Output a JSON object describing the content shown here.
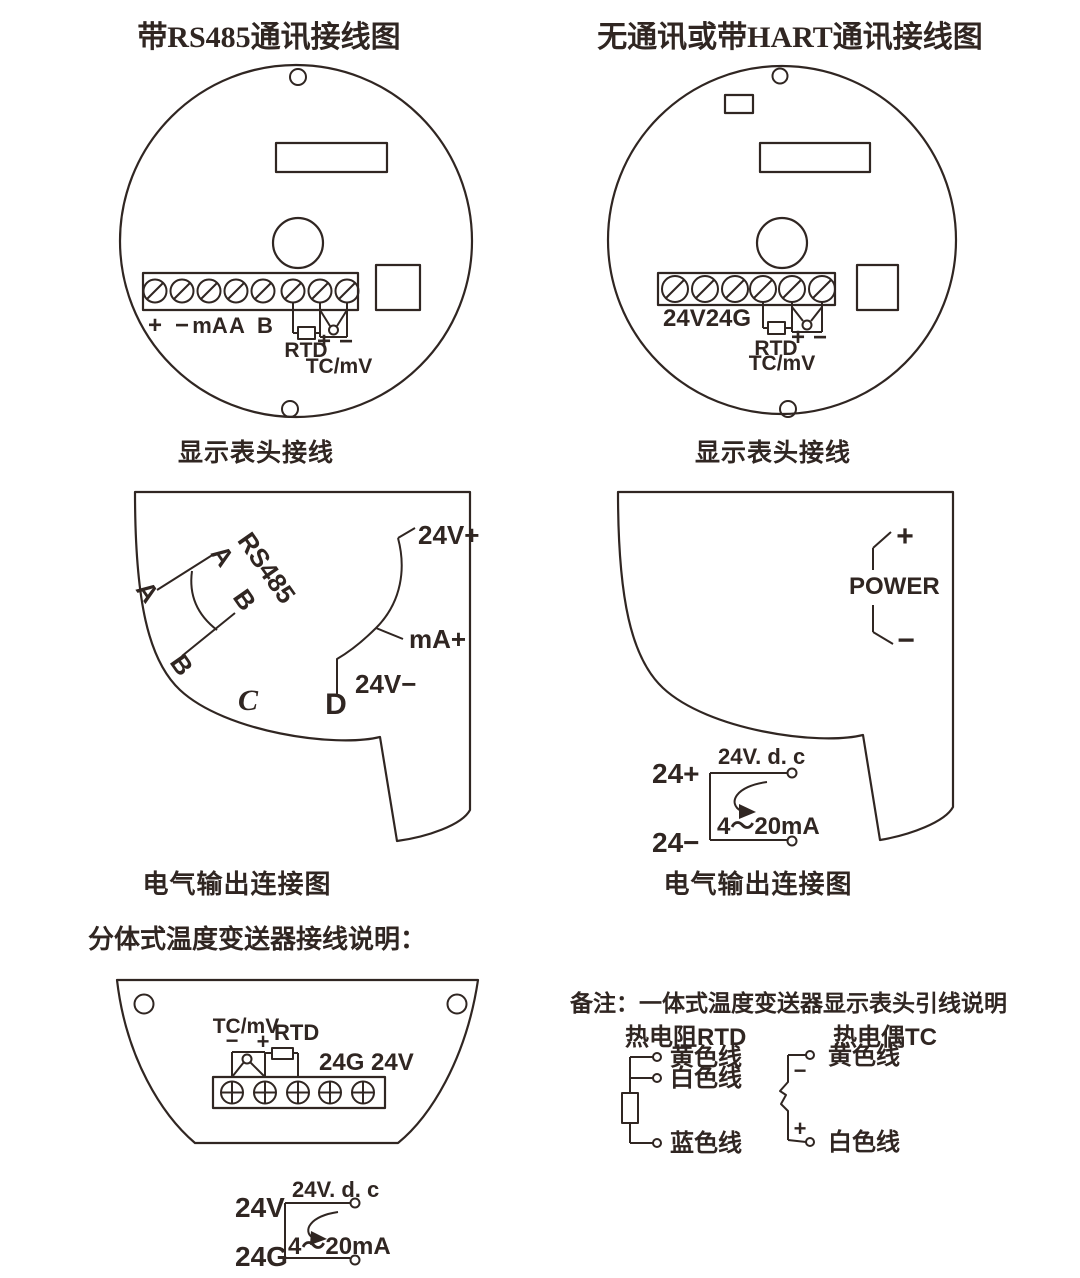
{
  "page": {
    "title_left": "带RS485通讯接线图",
    "title_right": "无通讯或带HART通讯接线图",
    "caption_display_left": "显示表头接线",
    "caption_display_right": "显示表头接线",
    "caption_output_left": "电气输出连接图",
    "caption_output_right": "电气输出连接图",
    "split_heading": "分体式温度变送器接线说明："
  },
  "head_rs485": {
    "terminals": [
      "+",
      "−",
      "mA",
      "A",
      "B"
    ],
    "rtd_label": "RTD",
    "plus": "+",
    "minus": "−",
    "tc_label": "TC/mV"
  },
  "head_hart": {
    "power_terminals": "24V24G",
    "rtd_label": "RTD",
    "plus": "+",
    "minus": "−",
    "tc_label": "TC/mV"
  },
  "output_rs485": {
    "wire_a_outer": "A",
    "wire_a_inner": "A",
    "bus_label": "RS485",
    "wire_b_inner": "B",
    "wire_b_outer": "B",
    "terminal_c": "C",
    "terminal_d": "D",
    "v_plus": "24V+",
    "ma_plus": "mA+",
    "v_minus": "24V−"
  },
  "output_hart": {
    "power_label": "POWER",
    "plus": "+",
    "minus": "−",
    "supply_label": "24V. d. c",
    "loop_plus": "24+",
    "loop_minus": "24−",
    "loop_current": "4～20mA"
  },
  "split_head": {
    "tc_label": "TC/mV",
    "minus": "−",
    "plus": "+",
    "rtd_label": "RTD",
    "power_label": "24G 24V"
  },
  "split_loop": {
    "supply_label": "24V. d. c",
    "v": "24V",
    "g": "24G",
    "loop_current": "4～20mA"
  },
  "note": {
    "heading": "备注：一体式温度变送器显示表头引线说明",
    "rtd_title": "热电阻RTD",
    "tc_title": "热电偶TC",
    "rtd_wires": [
      "黄色线",
      "白色线",
      "蓝色线"
    ],
    "tc_wire_top": "黄色线",
    "tc_wire_bottom": "白色线",
    "tc_minus": "−",
    "tc_plus": "+"
  },
  "colors": {
    "ink": "#302622",
    "background": "#ffffff"
  }
}
